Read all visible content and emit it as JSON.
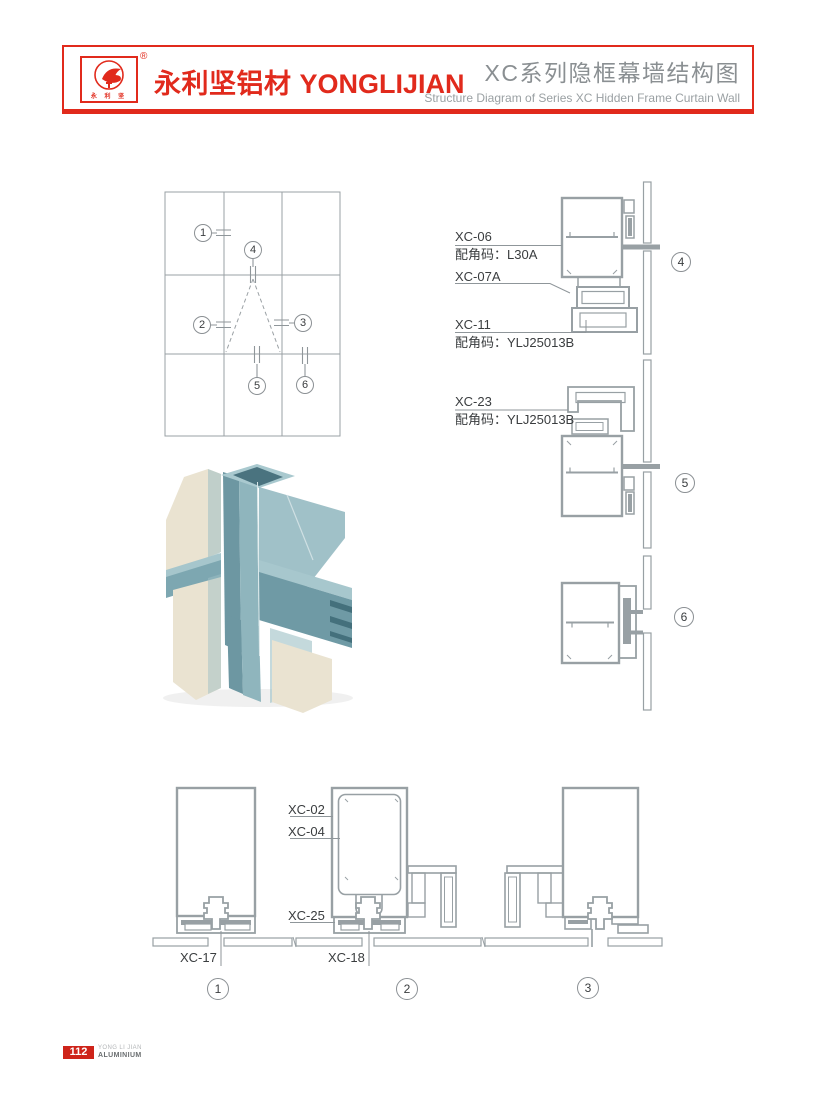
{
  "header": {
    "logo": {
      "registered_mark": "®",
      "seal_chars": "永 利 坚"
    },
    "brand_cn": "永利坚铝材",
    "brand_en": "YONGLIJIAN",
    "title_cn": "XC系列隐框幕墙结构图",
    "title_en": "Structure Diagram of Series XC Hidden Frame Curtain Wall"
  },
  "labels": {
    "xc06": "XC-06",
    "xc06_code": "配角码：L30A",
    "xc07a": "XC-07A",
    "xc11": "XC-11",
    "xc11_code": "配角码：YLJ25013B",
    "xc23": "XC-23",
    "xc23_code": "配角码：YLJ25013B",
    "xc02": "XC-02",
    "xc04": "XC-04",
    "xc25": "XC-25",
    "xc17": "XC-17",
    "xc18": "XC-18"
  },
  "callouts": {
    "n1": "1",
    "n2": "2",
    "n3": "3",
    "n4": "4",
    "n5": "5",
    "n6": "6"
  },
  "colors": {
    "accent_red": "#e12a1c",
    "drawing_gray": "#98a0a4",
    "render_teal": "#7da7b1",
    "render_beige": "#eae3d1"
  },
  "footer": {
    "page_number": "112",
    "brand_top": "YONG LI JIAN",
    "brand_bottom": "ALUMINIUM"
  }
}
